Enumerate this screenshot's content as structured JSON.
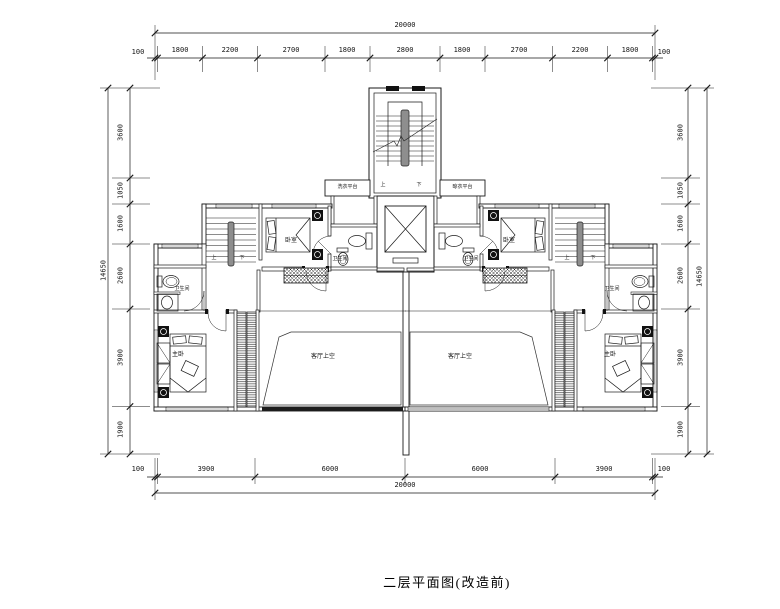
{
  "title": "二层平面图(改造前)",
  "colors": {
    "line": "#1a1a1a",
    "background": "#ffffff",
    "window_band": "#bfbfbf",
    "glazing_dark": "#1c1c1c",
    "stair_rail": "#8e8e8e"
  },
  "dimensions": {
    "top": {
      "total": "20000",
      "end_left": "100",
      "end_right": "100",
      "segments": [
        "1800",
        "2200",
        "2700",
        "1800",
        "2800",
        "1800",
        "2700",
        "2200",
        "1800"
      ]
    },
    "bottom": {
      "total": "20000",
      "end_left": "100",
      "end_right": "100",
      "segments": [
        "3900",
        "6000",
        "6000",
        "3900"
      ]
    },
    "left": {
      "total": "14650",
      "segments": [
        "3600",
        "1050",
        "1600",
        "2600",
        "3900",
        "1900"
      ]
    },
    "right": {
      "total": "14650",
      "segments": [
        "3600",
        "1050",
        "1600",
        "2600",
        "3900",
        "1900"
      ]
    }
  },
  "labels": {
    "platform_left": "洗衣平台",
    "platform_right": "晾衣平台",
    "stair_up": "上",
    "stair_down": "下",
    "left_unit": {
      "bedroom": "卧室",
      "bath_center": "卫生间",
      "bath_outer": "卫生间",
      "master": "主卧",
      "living_void": "客厅上空"
    },
    "right_unit": {
      "bedroom": "卧室",
      "bath_center": "卫生间",
      "bath_outer": "卫生间",
      "master": "主卧",
      "living_void": "客厅上空"
    }
  }
}
